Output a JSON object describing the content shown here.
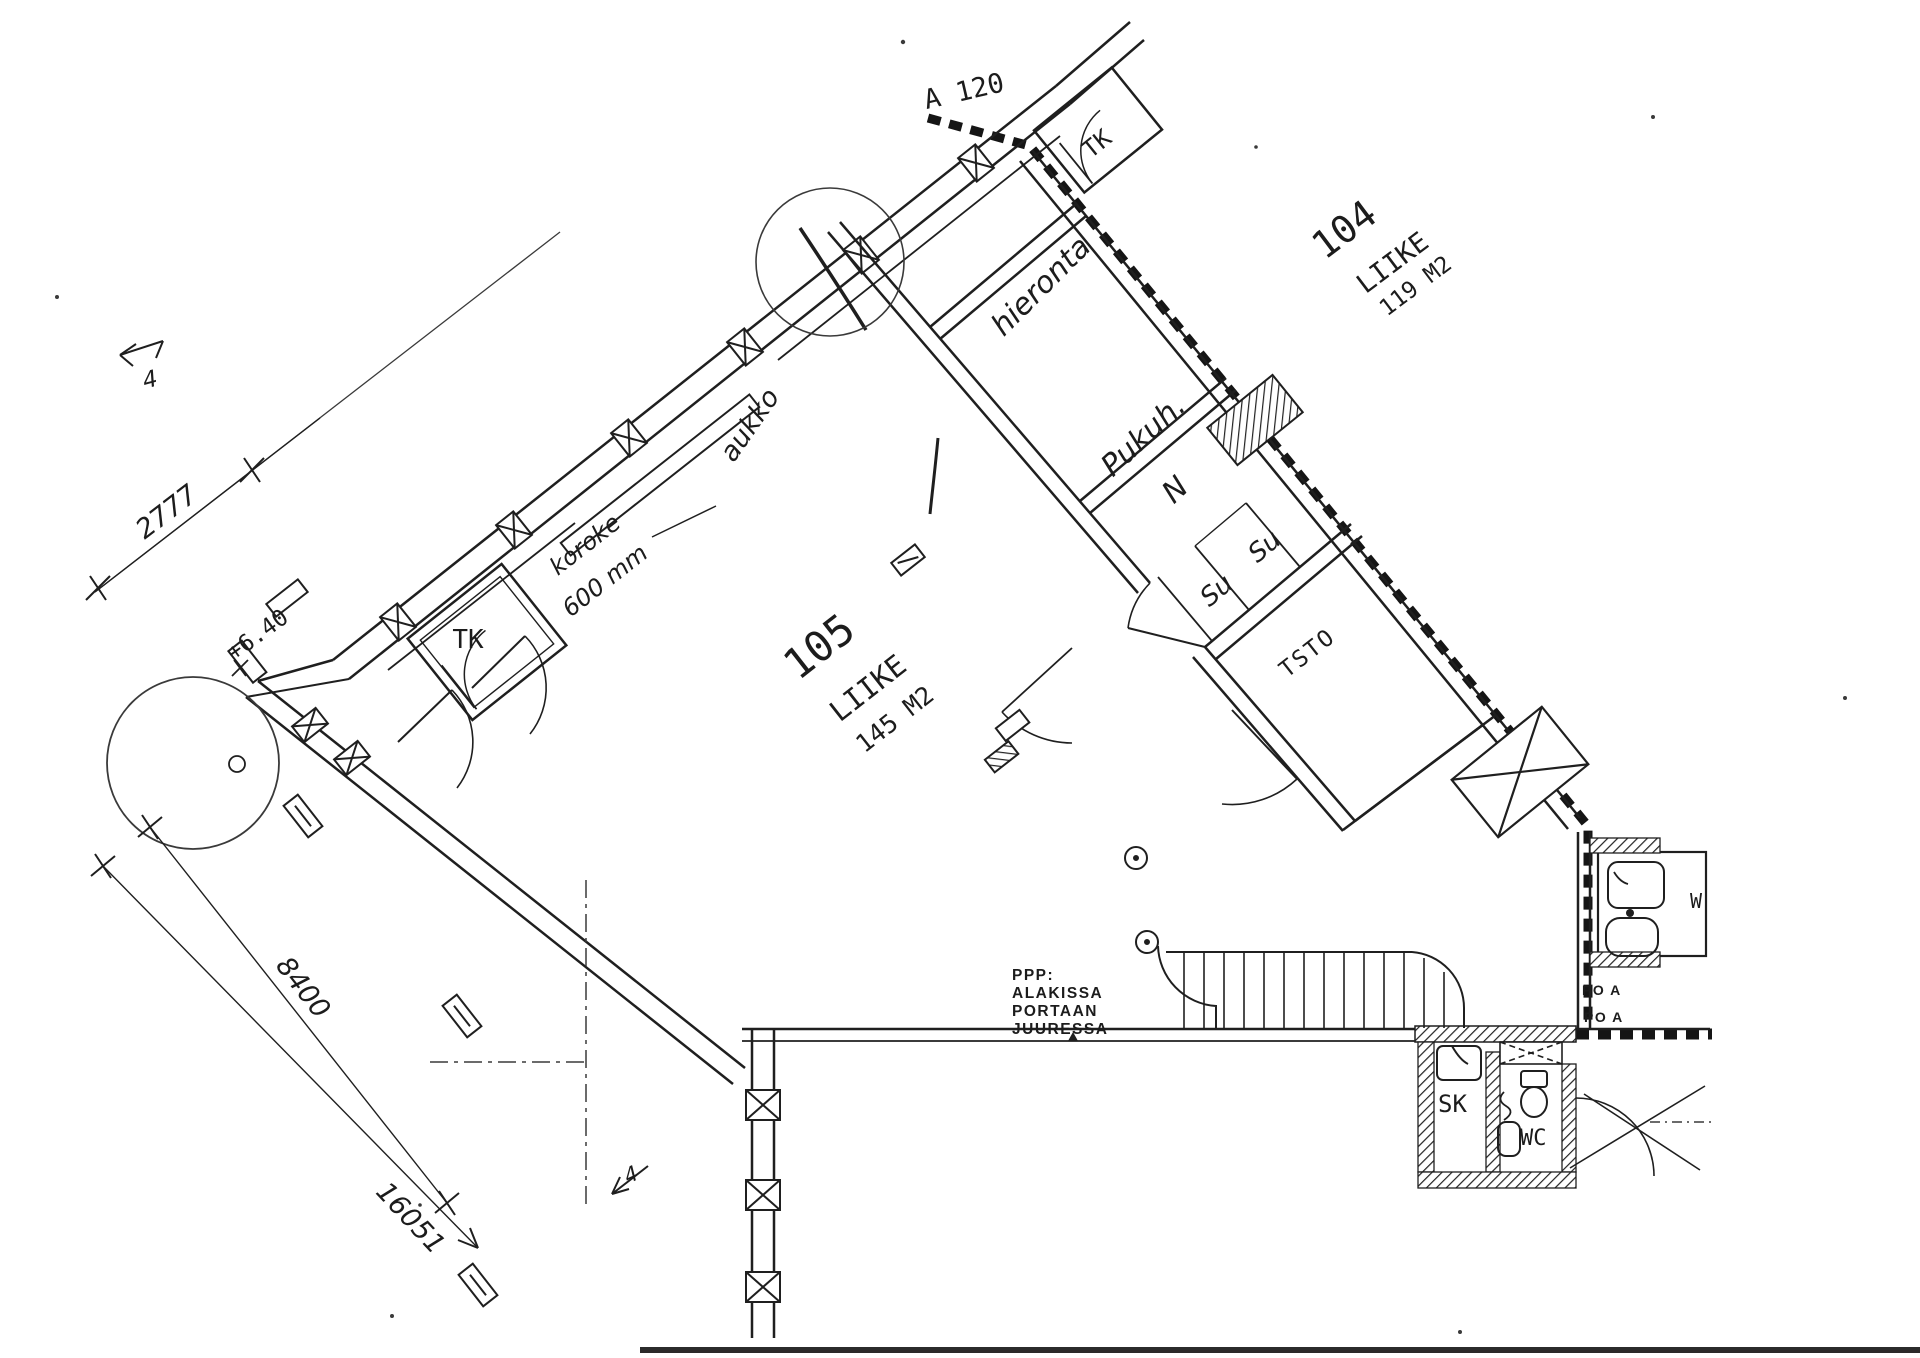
{
  "plan": {
    "rooms": {
      "unit104": {
        "number": "104",
        "type": "LIIKE",
        "area": "119 M2"
      },
      "unit105": {
        "number": "105",
        "type": "LIIKE",
        "area": "145 M2"
      },
      "tk_top": {
        "label": "TK"
      },
      "tk_left": {
        "label": "TK"
      },
      "hieronta": {
        "label": "hieronta"
      },
      "pukuh": {
        "line1": "Pukuh.",
        "line2": "N"
      },
      "su_left": {
        "label": "Su"
      },
      "su_right": {
        "label": "Su"
      },
      "tsto": {
        "label": "TSTO"
      },
      "sk": {
        "label": "SK"
      },
      "wc": {
        "label": "WC"
      },
      "wc_right": {
        "label": "W"
      }
    },
    "annotations": {
      "section_ref": "A 120",
      "aukko": "aukko",
      "koroke_line1": "koroke",
      "koroke_line2": "600 mm",
      "level": "+6.40",
      "ppp": {
        "line1": "PPP:",
        "line2": "ALAKISSA",
        "line3": "PORTAAN",
        "line4": "JUURESSA"
      },
      "po_a_1": "PO A",
      "po_a_2": "PO A",
      "section_mark_top": "4",
      "section_mark_bottom": "4"
    },
    "dimensions": {
      "d1": "2777",
      "d2": "8400",
      "d3": "16051"
    },
    "colors": {
      "ink": "#1c1c1c",
      "paper": "#ffffff"
    }
  }
}
